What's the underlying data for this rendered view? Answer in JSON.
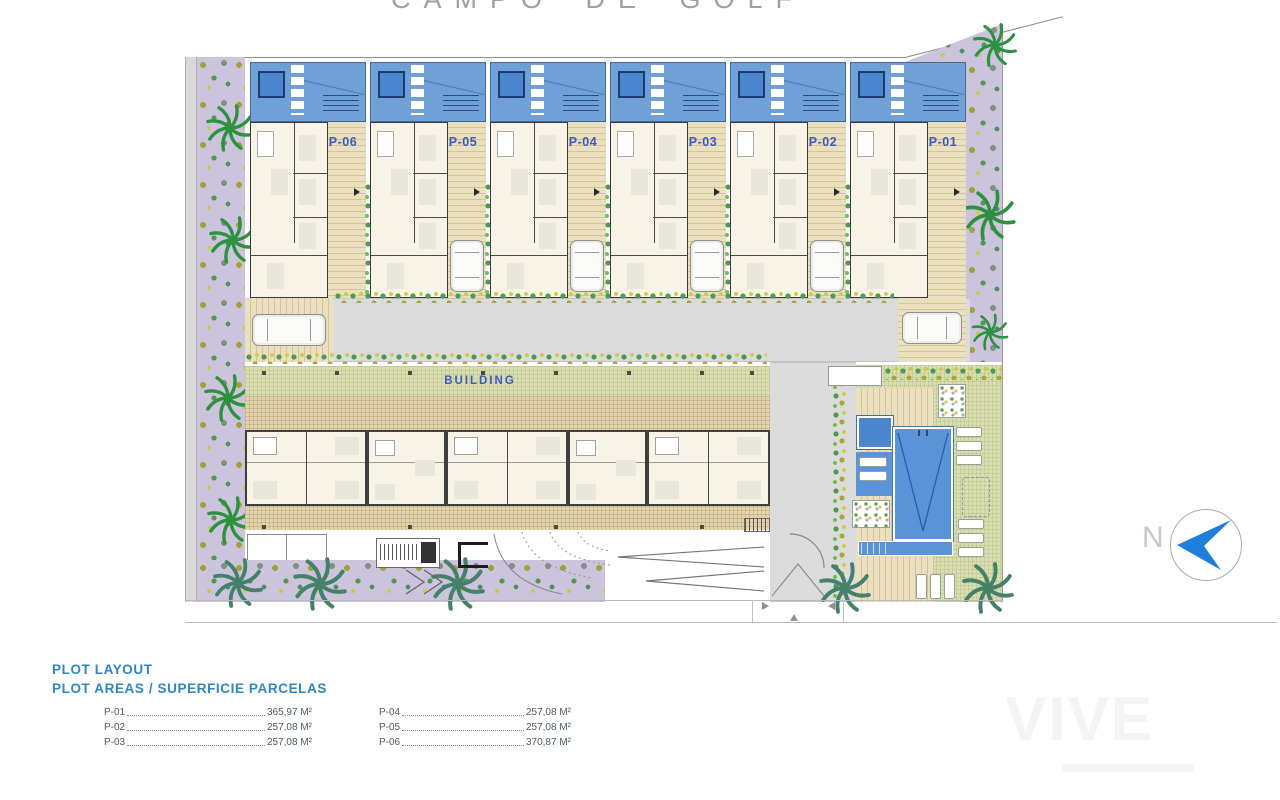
{
  "page": {
    "title": "CAMPO DE GOLF",
    "watermark": "VIVE"
  },
  "plan": {
    "building_label": "BUILDING",
    "north_label": "N",
    "plots": [
      {
        "label": "P-06"
      },
      {
        "label": "P-05"
      },
      {
        "label": "P-04"
      },
      {
        "label": "P-03"
      },
      {
        "label": "P-02"
      },
      {
        "label": "P-01"
      }
    ]
  },
  "legend": {
    "title": "PLOT LAYOUT",
    "subtitle": "PLOT AREAS / SUPERFICIE PARCELAS",
    "columns": [
      [
        {
          "plot": "P-01",
          "area": "365,97 M²"
        },
        {
          "plot": "P-02",
          "area": "257,08 M²"
        },
        {
          "plot": "P-03",
          "area": "257,08 M²"
        }
      ],
      [
        {
          "plot": "P-04",
          "area": "257,08 M²"
        },
        {
          "plot": "P-05",
          "area": "257,08 M²"
        },
        {
          "plot": "P-06",
          "area": "370,87 M²"
        }
      ]
    ]
  },
  "colors": {
    "roof_blue": "#6FA0D8",
    "pool_blue": "#5B93D8",
    "label_blue": "#3A5BBE",
    "legend_blue": "#2F86C2",
    "north_arrow_blue": "#1F7EDC"
  }
}
